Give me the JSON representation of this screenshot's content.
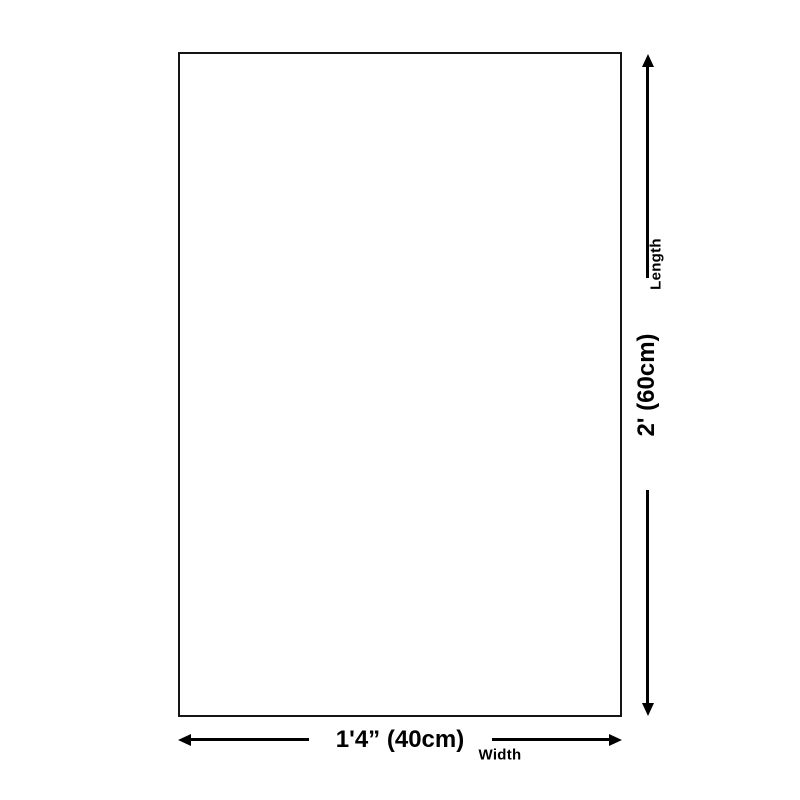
{
  "diagram": {
    "type": "product-dimension-diagram",
    "background_color": "#ffffff",
    "line_color": "#000000",
    "product_outline": {
      "shape": "rectangle"
    },
    "length_dimension": {
      "label": "Length",
      "value": "2' (60cm)",
      "orientation": "vertical"
    },
    "width_dimension": {
      "label": "Width",
      "value": "1'4” (40cm)",
      "orientation": "horizontal"
    }
  }
}
